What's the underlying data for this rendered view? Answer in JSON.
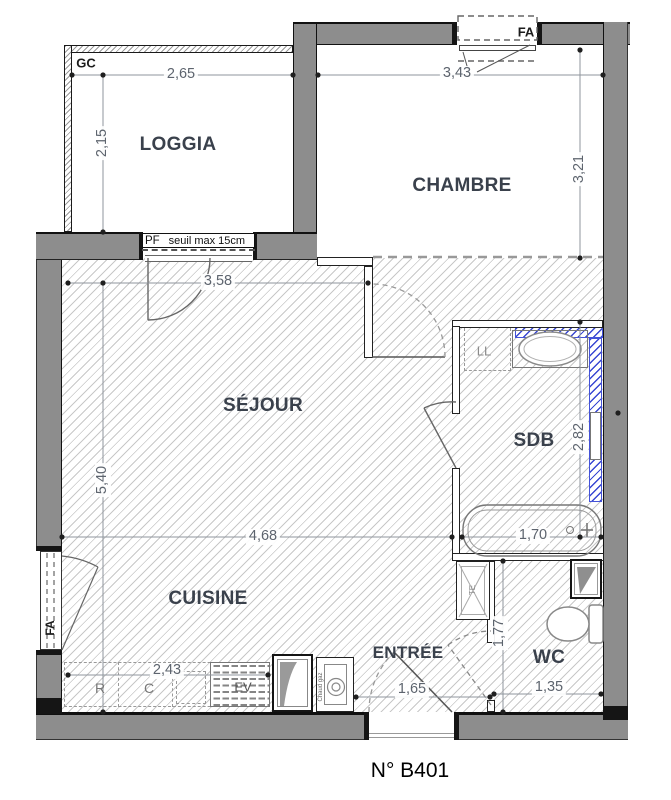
{
  "title": "N° B401",
  "rooms": {
    "loggia": "LOGGIA",
    "chambre": "CHAMBRE",
    "sejour": "SÉJOUR",
    "sdb": "SDB",
    "cuisine": "CUISINE",
    "entree": "ENTRÉE",
    "wc": "WC"
  },
  "annotations": {
    "gc": "GC",
    "pf": "PF",
    "seuil": "seuil max 15cm",
    "fa_top": "FA",
    "fa_left": "FA",
    "ll": "LL",
    "te": "TE",
    "fridge": "R",
    "cooker": "C",
    "kitchen_sink": "EV",
    "boiler": "Chaud gaz"
  },
  "dimensions": {
    "loggia_width": "2,65",
    "loggia_depth": "2,15",
    "chambre_width": "3,43",
    "chambre_depth": "3,21",
    "sejour_top_width": "3,58",
    "sejour_height": "5,40",
    "sejour_width": "4,68",
    "bathtub_width": "1,70",
    "sdb_height": "2,82",
    "kitchen_counter_width": "2,43",
    "entree_width": "1,65",
    "wc_width": "1,35",
    "wc_height": "1,77"
  },
  "colors": {
    "wall": "#8d8d8d",
    "insulation_blue": "#3847d2",
    "hatch_gray": "#6e6e6e"
  }
}
